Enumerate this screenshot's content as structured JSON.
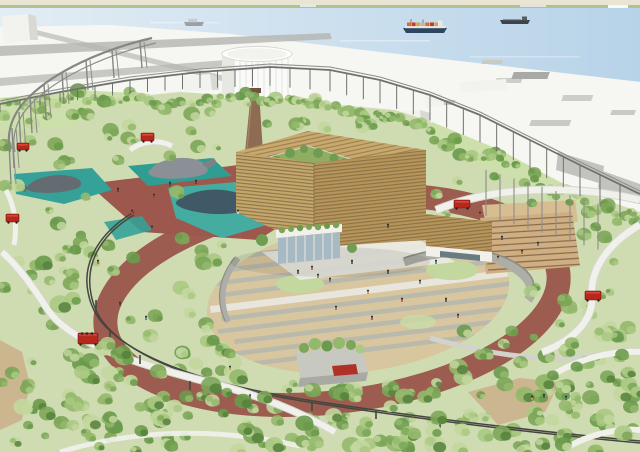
{
  "palette": {
    "shore_land": "#e9e5d2",
    "shore_trees": "#a5bd87",
    "water_light": "#e3edf5",
    "water_deep": "#b7d3e8",
    "wharf": "#f6f6f2",
    "road": "#b4b5b0",
    "smudge": "#c9cac4",
    "massing_white": "#f2f2ee",
    "massing_shade": "#d9d9d4",
    "gray_block": "#c2c3be",
    "park_base": "#cfdcb2",
    "lawn": "#cde0ab",
    "track": "#9a544b",
    "track_plaza": "#9d574d",
    "sand": "#d8c69e",
    "concrete": "#b4b7ae",
    "plaza_white": "#ecece6",
    "teal_deck": "#2f9d92",
    "teal_pool": "#45aca2",
    "teal_pond": "#36a198",
    "whale_gray": "#8a9095",
    "whale_dark": "#646c72",
    "whale_silhouette": "#3f5261",
    "wood": "#c5a66a",
    "wood_side": "#b6945a",
    "wood_roof": "#caa96d",
    "wood_line": "#77643e",
    "garden": "#8fae63",
    "garden_tree": "#6e9c50",
    "chimney": "#8e6b53",
    "chimney_cap": "#6f5240",
    "tank": "#fafaf8",
    "tank_shade": "#e8e8e3",
    "tank_line": "#dcdcd6",
    "storefront": "#f1f0ea",
    "glass": "#a7b9c2",
    "glass_dark": "#6b7b82",
    "steps": "#cfae82",
    "steps_line": "#8a6f50",
    "steps_deck": "#d6bd92",
    "wall": "#adaea7",
    "wall_edge": "#8c8d86",
    "guideway": "#f1f1ec",
    "guideway_edge": "#d6d6d0",
    "rail_dark": "#44463f",
    "fence": "#6f716c",
    "pole": "#8b8d88",
    "structure": "#858782",
    "car_red": "#b6281c",
    "car_red_dark": "#7e1410",
    "dirt": "#ccb690",
    "path_gray": "#d3d3cd",
    "ship_hull": "#2d4660",
    "ship_dark": "#3c434a",
    "ship_gray": "#9aa0a5",
    "container1": "#d86b2a",
    "container2": "#c23b2e",
    "container3": "#d9a43c",
    "tree_colors": [
      "#c3d79f",
      "#aac983",
      "#93b96c",
      "#7ca658",
      "#6a9a4b"
    ],
    "tree_dark": "#55813c"
  },
  "scene": {
    "ships": [
      {
        "name": "container-ship",
        "x": 403,
        "y": 19
      },
      {
        "name": "tanker-ship",
        "x": 500,
        "y": 14
      },
      {
        "name": "small-ship",
        "x": 184,
        "y": 16
      }
    ],
    "red_cars": [
      {
        "x": 17,
        "y": 143,
        "w": 12,
        "h": 7
      },
      {
        "x": 6,
        "y": 214,
        "w": 13,
        "h": 8
      },
      {
        "x": 78,
        "y": 333,
        "w": 20,
        "h": 11
      },
      {
        "x": 141,
        "y": 133,
        "w": 13,
        "h": 8
      },
      {
        "x": 454,
        "y": 200,
        "w": 16,
        "h": 8
      },
      {
        "x": 585,
        "y": 291,
        "w": 16,
        "h": 9
      }
    ],
    "red_canopy": {
      "x": 332,
      "y": 365
    },
    "people": [
      [
        312,
        270,
        "#c7443a"
      ],
      [
        330,
        282,
        "#3b6ea5"
      ],
      [
        352,
        264,
        "#444444"
      ],
      [
        368,
        294,
        "#d9893b"
      ],
      [
        388,
        274,
        "#444444"
      ],
      [
        402,
        302,
        "#c7443a"
      ],
      [
        420,
        284,
        "#777777"
      ],
      [
        436,
        264,
        "#3b6ea5"
      ],
      [
        446,
        302,
        "#444444"
      ],
      [
        372,
        320,
        "#884466"
      ],
      [
        336,
        310,
        "#777777"
      ],
      [
        458,
        318,
        "#c7443a"
      ],
      [
        118,
        192,
        "#444444"
      ],
      [
        132,
        214,
        "#c7443a"
      ],
      [
        152,
        230,
        "#3b6ea5"
      ],
      [
        170,
        186,
        "#444444"
      ],
      [
        196,
        184,
        "#444444"
      ],
      [
        238,
        214,
        "#dddddd"
      ],
      [
        154,
        198,
        "#884466"
      ],
      [
        98,
        264,
        "#c7443a"
      ],
      [
        120,
        306,
        "#444444"
      ],
      [
        146,
        320,
        "#3b6ea5"
      ],
      [
        230,
        370,
        "#d9893b"
      ],
      [
        388,
        228,
        "#444444"
      ],
      [
        480,
        216,
        "#c7443a"
      ],
      [
        502,
        240,
        "#444444"
      ],
      [
        522,
        254,
        "#c7443a"
      ],
      [
        538,
        246,
        "#3b6ea5"
      ],
      [
        498,
        260,
        "#d9893b"
      ],
      [
        532,
        400,
        "#d9a53b"
      ],
      [
        544,
        398,
        "#444444"
      ],
      [
        566,
        400,
        "#3b6ea5"
      ],
      [
        298,
        274,
        "#444444"
      ],
      [
        318,
        278,
        "#777777"
      ]
    ],
    "whales": [
      {
        "name": "whale-sculpture-center"
      },
      {
        "name": "whale-sculpture-pond"
      },
      {
        "name": "whale-silhouette-pool"
      }
    ],
    "tree_seed": 7
  }
}
